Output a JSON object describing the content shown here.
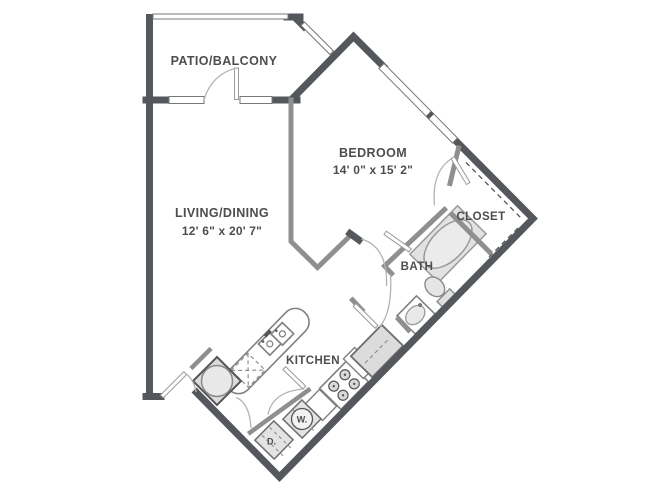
{
  "labels": {
    "patio": "PATIO/BALCONY",
    "living": "LIVING/DINING",
    "living_dims": "12' 6\" x 20' 7\"",
    "bedroom": "BEDROOM",
    "bedroom_dims": "14' 0\" x 15' 2\"",
    "closet": "CLOSET",
    "bath": "BATH",
    "kitchen": "KITCHEN",
    "washer": "W.",
    "dryer": "D."
  },
  "fixtures": {
    "bathtub": "bathtub",
    "toilet": "toilet",
    "bath_sink": "bath-sink",
    "kitchen_sink": "double-kitchen-sink",
    "dishwasher": "dishwasher",
    "stove": "range-stove-4-burners",
    "refrigerator": "refrigerator",
    "washer": "washer",
    "dryer": "dryer",
    "water_heater": "water-heater"
  },
  "colors": {
    "exterior_wall": "#54575b",
    "interior_wall": "#8f8f8f",
    "fixture_fill": "#e2e2e2",
    "fixture_stroke": "#9a9a9a",
    "label_text": "#4d4d4d",
    "background": "#ffffff"
  }
}
